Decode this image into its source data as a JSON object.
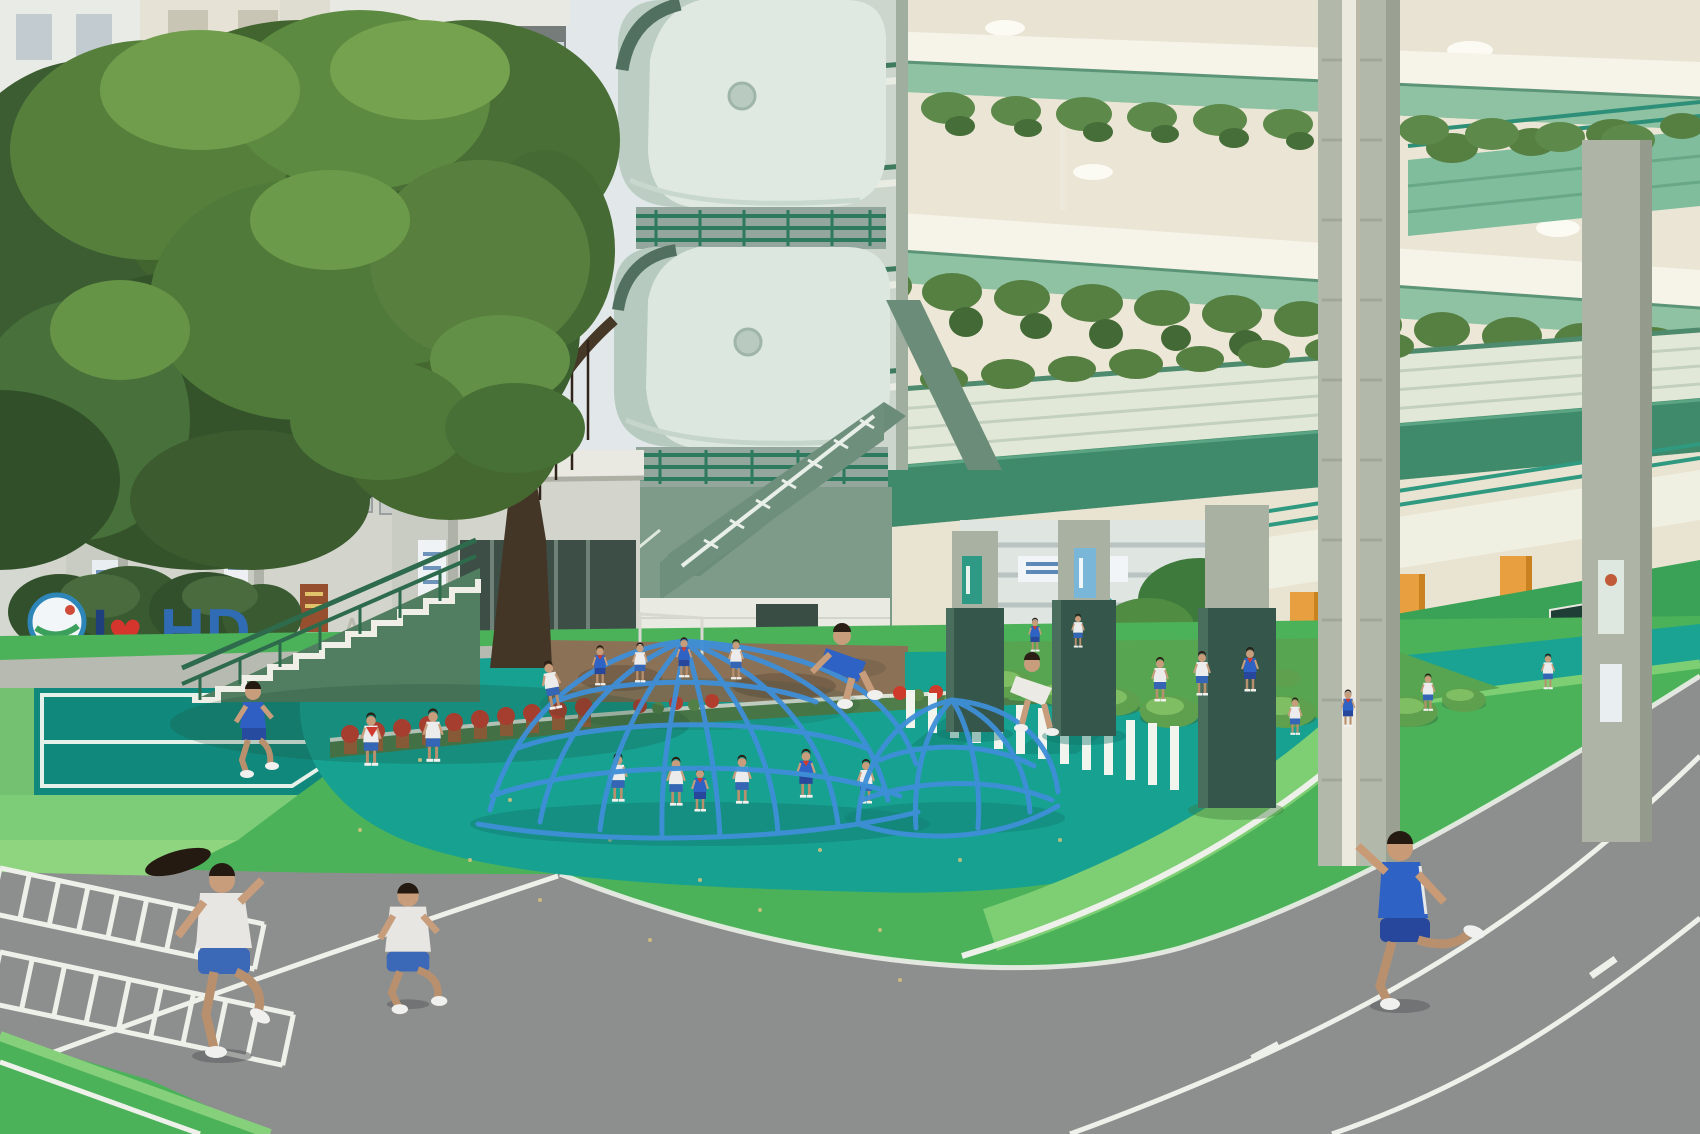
{
  "meta": {
    "title": "Primary school courtyard with colorful playground",
    "type": "photograph",
    "description": "Elevated view of a school courtyard: a large ficus tree in front of high-rise towers, a mint-green rounded stair tower, a cream-and-green school building draped with vines, and a playground with teal and green rubber surfacing, a blue climbing dome, grass mounds, white agility markings and a gray running track with children in uniform running and climbing."
  },
  "sign": {
    "i": "I",
    "heart": "♥",
    "hd": "HD"
  },
  "scene": {
    "objects": [
      "ficus-tree",
      "high-rise-apartments",
      "rounded-stair-tower",
      "vine-covered-balconies",
      "green-walkway-beam",
      "tiled-columns",
      "padded-column-guards",
      "entrance-stairs",
      "flower-pots",
      "hedge",
      "i-love-hd-sign",
      "climbing-dome",
      "grass-mounds",
      "zebra-agility-stripes",
      "agility-ladder-markings",
      "running-track",
      "teal-play-surface",
      "dark-teal-court",
      "inner-courtyard",
      "slide",
      "children-running",
      "children-climbing"
    ],
    "children": {
      "total_visible": 28,
      "uniforms": "white shirts with blue shorts; some all-blue sports uniforms with red neckerchiefs"
    }
  },
  "colors": {
    "sky": "#e2e8e9",
    "tree_dark": "#35532b",
    "tree_mid": "#4f7a39",
    "tree_light": "#6f9d4c",
    "tower_wall": "#dfe9e2",
    "tower_shadow": "#b9cbc1",
    "tower_green": "#7e9b89",
    "rail_green": "#2e7a5e",
    "facade_cream": "#efe9da",
    "slab_white": "#f6f3e9",
    "fascia_green": "#8fc2a2",
    "beam_green": "#3e8a6a",
    "vine_green": "#567f42",
    "orange_accent": "#e79f3f",
    "teal_rail": "#2f9a80",
    "wall_green": "#3aa257",
    "column_tile": "#aab3a3",
    "pad_dark": "#35564a",
    "play_teal": "#17a191",
    "court_teal": "#11887c",
    "field_green": "#4cb25a",
    "apron_light": "#7ccc78",
    "track_gray": "#8d8f8e",
    "line_white": "#eef0ea",
    "dome_blue": "#3f8fd8",
    "mound_green": "#57a550",
    "soil_brown": "#8b7257",
    "flower_red": "#cc3b2c",
    "pot_terracotta": "#a65f38",
    "skin": "#c79d7c",
    "shirt_white": "#ececec",
    "shorts_blue": "#3565b5",
    "uniform_blue": "#2e62c4",
    "scarf_red": "#d03a30",
    "hair_dark": "#2a1e15",
    "sign_blue": "#2f6cb3",
    "heart_red": "#d5352c"
  }
}
